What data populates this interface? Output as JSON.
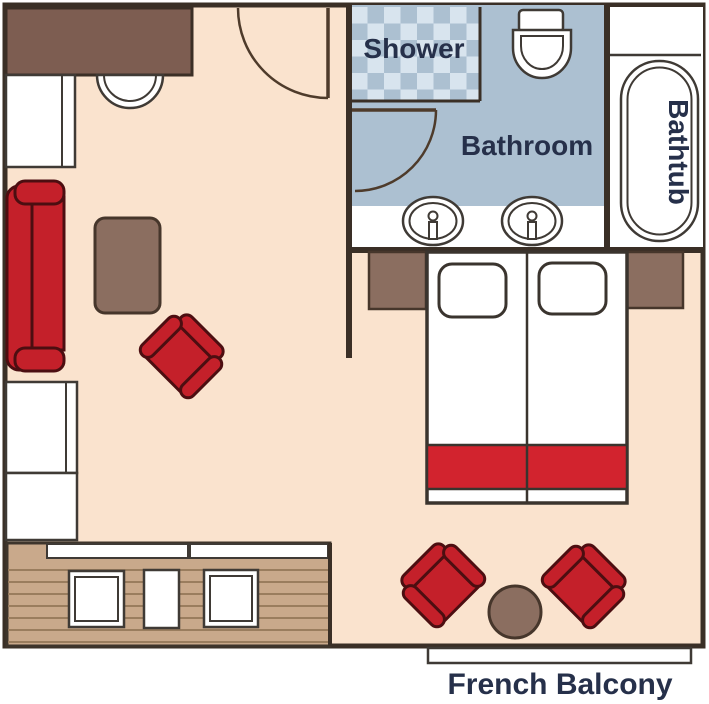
{
  "plan": {
    "labels": {
      "shower": "Shower",
      "bathroom": "Bathroom",
      "bathtub": "Bathtub",
      "french_balcony": "French Balcony"
    },
    "colors": {
      "floor": "#FAE3CE",
      "wall": "#3A2F26",
      "door": "#4E3B2B",
      "accent_red": "#C4202A",
      "red_outline": "#4C0E11",
      "bed_runner": "#D2232E",
      "bathroom_blue": "#ACC0D1",
      "checker_light": "#D8E4EE",
      "wood": "#C9A98B",
      "plank": "#9A7D5E",
      "furniture_brown": "#8B6E60",
      "desk_brown": "#7D5D51",
      "label_navy": "#26304A"
    }
  }
}
